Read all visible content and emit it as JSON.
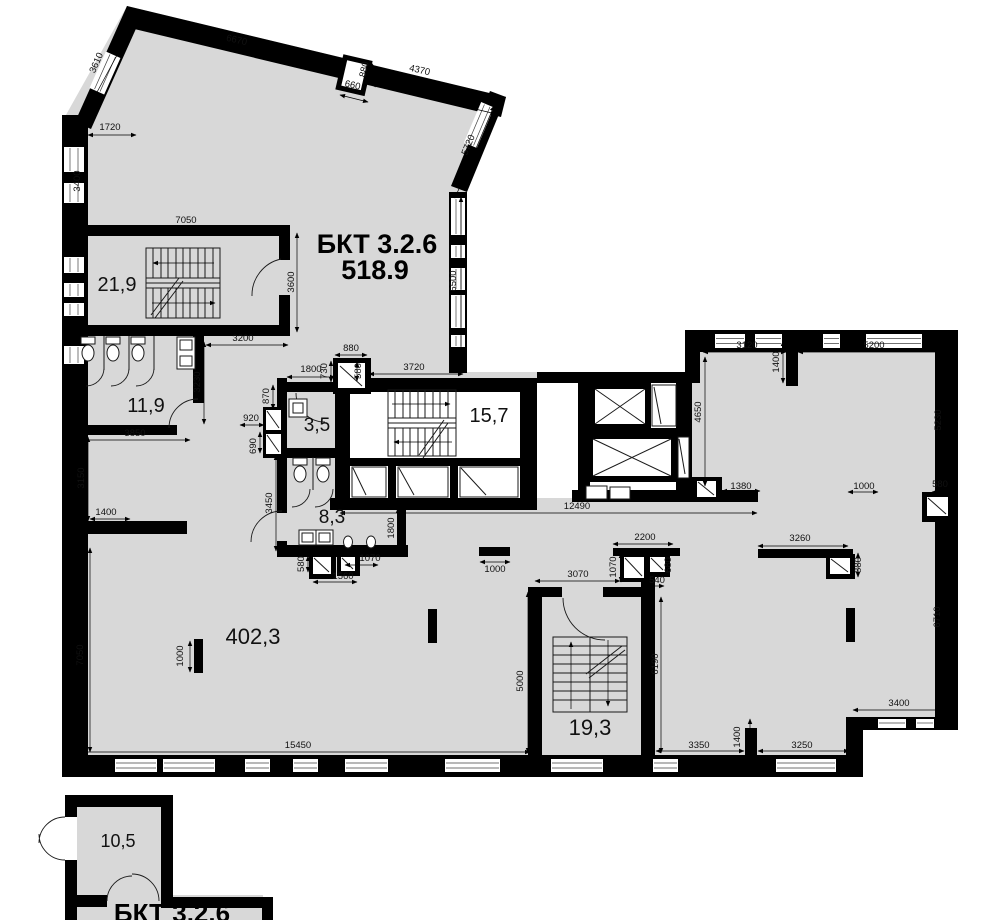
{
  "plan": {
    "title": {
      "line1": "БКТ 3.2.6",
      "line2": "518.9"
    },
    "annex_title": "БКТ 3.2.6",
    "colors": {
      "floor": "#d8d8d8",
      "wall": "#000000",
      "dimension_text": "#111111"
    },
    "rooms": [
      {
        "name": "stairwell-a",
        "area": "21,9",
        "x": 117,
        "y": 291,
        "size": 20
      },
      {
        "name": "wc-block",
        "area": "11,9",
        "x": 146,
        "y": 412,
        "size": 20
      },
      {
        "name": "lavatory",
        "area": "3,5",
        "x": 317,
        "y": 431,
        "size": 19
      },
      {
        "name": "stairwell-b",
        "area": "15,7",
        "x": 489,
        "y": 422,
        "size": 20
      },
      {
        "name": "wc-men",
        "area": "8,3",
        "x": 332,
        "y": 523,
        "size": 19
      },
      {
        "name": "open-space",
        "area": "402,3",
        "x": 253,
        "y": 644,
        "size": 22
      },
      {
        "name": "stairwell-c",
        "area": "19,3",
        "x": 590,
        "y": 735,
        "size": 22
      },
      {
        "name": "entrance-lobby",
        "area": "10,5",
        "x": 118,
        "y": 847,
        "size": 18
      }
    ],
    "dimensions_mm": [
      {
        "v": "6670",
        "x": 236,
        "y": 43,
        "r": 13
      },
      {
        "v": "880",
        "x": 367,
        "y": 70,
        "r": -77
      },
      {
        "v": "660",
        "x": 352,
        "y": 88,
        "r": 13
      },
      {
        "v": "4370",
        "x": 419,
        "y": 73,
        "r": 13
      },
      {
        "v": "3610",
        "x": 99,
        "y": 64,
        "r": -66
      },
      {
        "v": "5720",
        "x": 471,
        "y": 146,
        "r": -68
      },
      {
        "v": "1720",
        "x": 110,
        "y": 130,
        "r": 0
      },
      {
        "v": "3400",
        "x": 80,
        "y": 181,
        "r": -90
      },
      {
        "v": "7050",
        "x": 186,
        "y": 223,
        "r": 0
      },
      {
        "v": "6500",
        "x": 456,
        "y": 281,
        "r": -90
      },
      {
        "v": "3600",
        "x": 294,
        "y": 282,
        "r": -90
      },
      {
        "v": "3200",
        "x": 243,
        "y": 341,
        "r": 0
      },
      {
        "v": "3850",
        "x": 135,
        "y": 436,
        "r": 0
      },
      {
        "v": "3230",
        "x": 200,
        "y": 382,
        "r": -90
      },
      {
        "v": "880",
        "x": 351,
        "y": 351,
        "r": 0
      },
      {
        "v": "1800",
        "x": 311,
        "y": 372,
        "r": 0
      },
      {
        "v": "730",
        "x": 327,
        "y": 371,
        "r": -90
      },
      {
        "v": "580",
        "x": 361,
        "y": 371,
        "r": -90
      },
      {
        "v": "3720",
        "x": 414,
        "y": 370,
        "r": 0
      },
      {
        "v": "870",
        "x": 269,
        "y": 396,
        "r": -90
      },
      {
        "v": "920",
        "x": 251,
        "y": 421,
        "r": 0
      },
      {
        "v": "690",
        "x": 256,
        "y": 446,
        "r": -90
      },
      {
        "v": "3450",
        "x": 272,
        "y": 503,
        "r": -90
      },
      {
        "v": "1800",
        "x": 394,
        "y": 528,
        "r": -90
      },
      {
        "v": "580",
        "x": 304,
        "y": 564,
        "r": -90
      },
      {
        "v": "1070",
        "x": 370,
        "y": 561,
        "r": 0
      },
      {
        "v": "1560",
        "x": 343,
        "y": 579,
        "r": 0
      },
      {
        "v": "12490",
        "x": 577,
        "y": 509,
        "r": 0
      },
      {
        "v": "1000",
        "x": 495,
        "y": 572,
        "r": 0
      },
      {
        "v": "1380",
        "x": 741,
        "y": 489,
        "r": 0
      },
      {
        "v": "3120",
        "x": 747,
        "y": 348,
        "r": 0
      },
      {
        "v": "5200",
        "x": 874,
        "y": 348,
        "r": 0
      },
      {
        "v": "1400",
        "x": 779,
        "y": 362,
        "r": -90
      },
      {
        "v": "4650",
        "x": 701,
        "y": 412,
        "r": -90
      },
      {
        "v": "5230",
        "x": 941,
        "y": 420,
        "r": -90
      },
      {
        "v": "1000",
        "x": 864,
        "y": 489,
        "r": 0
      },
      {
        "v": "580",
        "x": 940,
        "y": 487,
        "r": 0
      },
      {
        "v": "3260",
        "x": 800,
        "y": 541,
        "r": 0
      },
      {
        "v": "880",
        "x": 861,
        "y": 565,
        "r": -90
      },
      {
        "v": "2200",
        "x": 645,
        "y": 540,
        "r": 0
      },
      {
        "v": "1070",
        "x": 616,
        "y": 567,
        "r": -90
      },
      {
        "v": "680",
        "x": 671,
        "y": 565,
        "r": -90
      },
      {
        "v": "540",
        "x": 657,
        "y": 583,
        "r": 0
      },
      {
        "v": "3070",
        "x": 578,
        "y": 577,
        "r": 0
      },
      {
        "v": "5000",
        "x": 523,
        "y": 681,
        "r": -90
      },
      {
        "v": "6190",
        "x": 658,
        "y": 664,
        "r": -90
      },
      {
        "v": "6710",
        "x": 940,
        "y": 617,
        "r": -90
      },
      {
        "v": "3400",
        "x": 899,
        "y": 706,
        "r": 0
      },
      {
        "v": "3350",
        "x": 699,
        "y": 748,
        "r": 0
      },
      {
        "v": "1400",
        "x": 740,
        "y": 737,
        "r": -90
      },
      {
        "v": "3250",
        "x": 802,
        "y": 748,
        "r": 0
      },
      {
        "v": "15450",
        "x": 298,
        "y": 748,
        "r": 0
      },
      {
        "v": "7050",
        "x": 83,
        "y": 655,
        "r": -90
      },
      {
        "v": "3150",
        "x": 84,
        "y": 478,
        "r": -90
      },
      {
        "v": "1400",
        "x": 106,
        "y": 515,
        "r": 0
      },
      {
        "v": "1000",
        "x": 183,
        "y": 656,
        "r": -90
      }
    ]
  }
}
